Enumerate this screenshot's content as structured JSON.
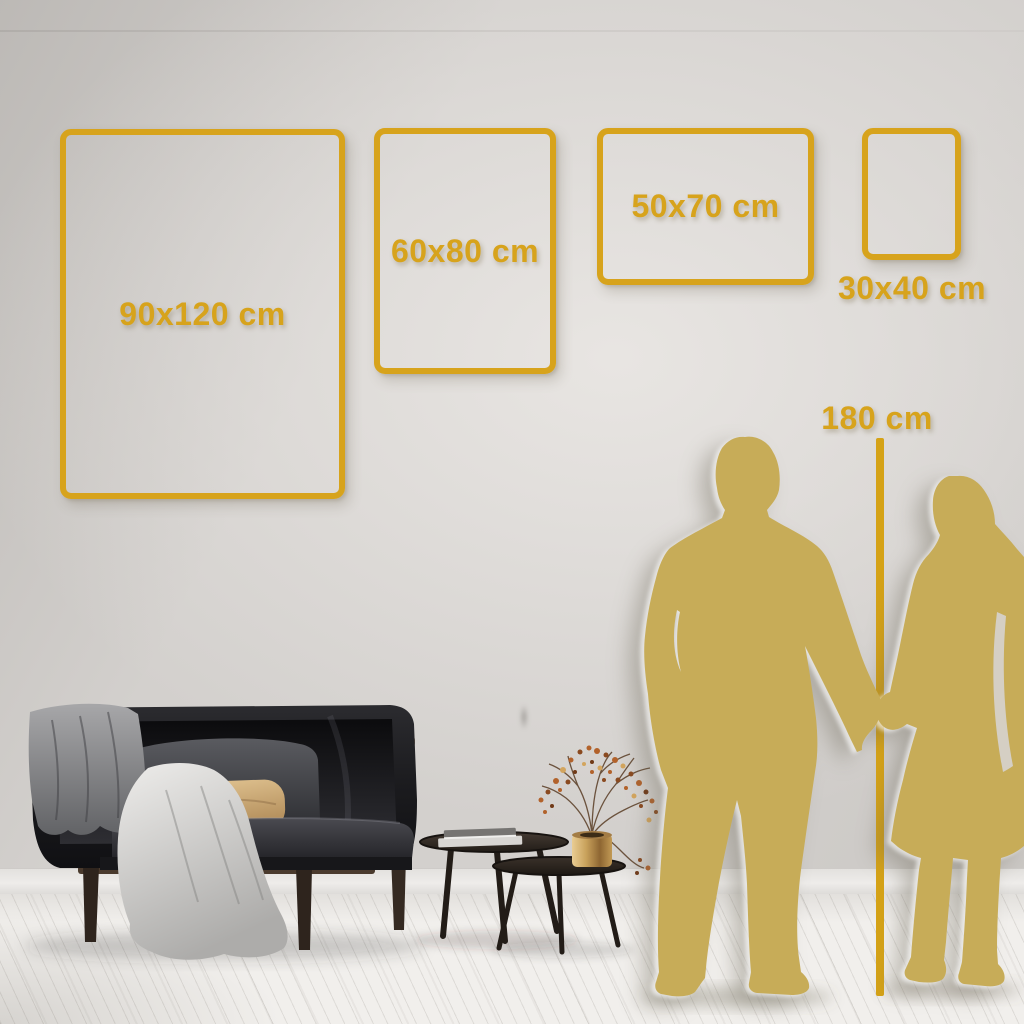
{
  "meta": {
    "title": "Poster size guide – room scene"
  },
  "frames": [
    {
      "id": "90x120",
      "label": "90x120 cm",
      "orientation": "portrait",
      "label_position": "center"
    },
    {
      "id": "60x80",
      "label": "60x80 cm",
      "orientation": "portrait",
      "label_position": "center"
    },
    {
      "id": "50x70",
      "label": "50x70 cm",
      "orientation": "landscape",
      "label_position": "center"
    },
    {
      "id": "30x40",
      "label": "30x40 cm",
      "orientation": "portrait",
      "label_position": "below"
    }
  ],
  "height_reference": {
    "label": "180 cm"
  },
  "colors": {
    "accent_gold": "#d7a31c",
    "silhouette_gold": "#c7ac58",
    "wall": "#d3d0cd",
    "floor": "#f1efec"
  },
  "scene_elements": [
    "dark-velvet-sofa",
    "gray-blanket",
    "white-throw-drape",
    "gray-back-pillow",
    "tan-accent-pillow",
    "nesting-coffee-tables",
    "book-stack",
    "brass-vase",
    "dried-berry-plant",
    "man-silhouette",
    "woman-silhouette",
    "height-reference-line"
  ]
}
